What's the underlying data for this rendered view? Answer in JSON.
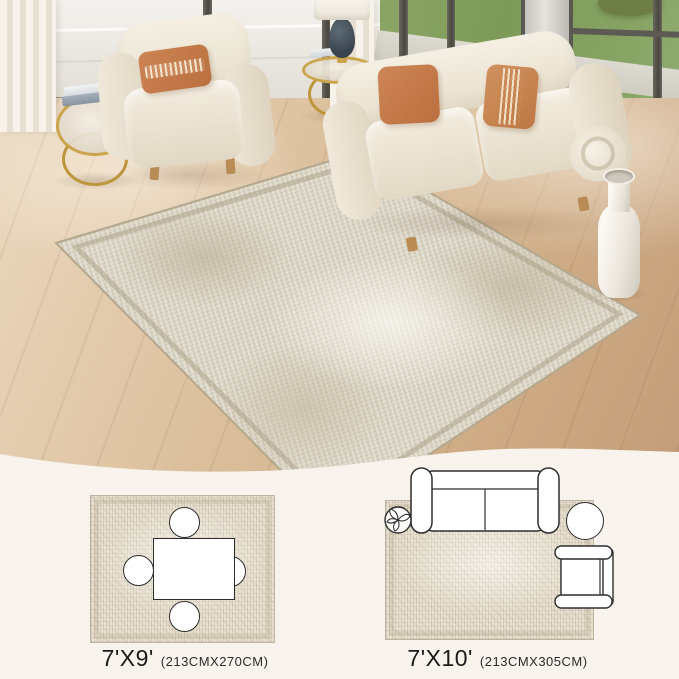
{
  "size_options": [
    {
      "size": "7'X9'",
      "dimensions": "(213CMX270CM)",
      "furniture_icons": [
        "dining-table",
        "chair",
        "chair",
        "chair",
        "chair"
      ]
    },
    {
      "size": "7'X10'",
      "dimensions": "(213CMX305CM)",
      "furniture_icons": [
        "loveseat-sofa",
        "potted-plant",
        "round-side-table",
        "armchair"
      ]
    }
  ],
  "scene": {
    "objects": [
      "area-rug",
      "loveseat-sofa",
      "armchair",
      "orange-throw-pillows",
      "gold-round-side-tables",
      "table-lamp",
      "books",
      "white-floor-vase",
      "sheer-curtains",
      "floor-to-ceiling-windows",
      "green-lawn",
      "light-wood-floor"
    ],
    "palette": {
      "cream_background": "#f8f3ec",
      "rug_beige": "#d8d2c1",
      "pillow_orange": "#c27a4b",
      "gold_accent": "#c2a14b",
      "lawn_green": "#829e60",
      "wood_floor": "#d5b896",
      "diagram_outline": "#2e2e2e"
    }
  }
}
